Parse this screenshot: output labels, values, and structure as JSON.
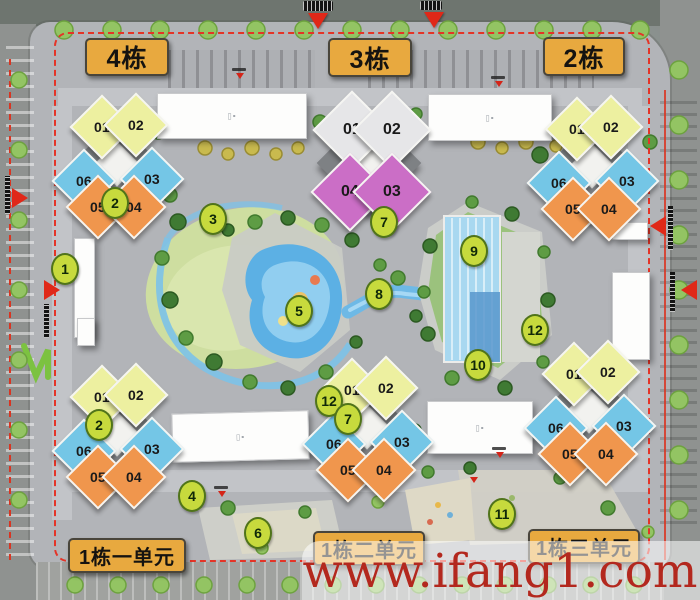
{
  "title": "residential-site-plan",
  "blocks": [
    {
      "label": "4栋",
      "units": [
        "01",
        "02",
        "06",
        "03",
        "05",
        "04"
      ]
    },
    {
      "label": "3栋",
      "units": [
        "01",
        "02",
        "04",
        "03"
      ]
    },
    {
      "label": "2栋",
      "units": [
        "01",
        "02",
        "06",
        "03",
        "05",
        "04"
      ]
    },
    {
      "label": "1栋一单元",
      "units": [
        "01",
        "02",
        "06",
        "03",
        "05",
        "04"
      ]
    },
    {
      "label": "1栋二单元",
      "units": [
        "01",
        "02",
        "06",
        "03",
        "05",
        "04"
      ]
    },
    {
      "label": "1栋三单元",
      "units": [
        "01",
        "02",
        "06",
        "03",
        "05",
        "04"
      ]
    }
  ],
  "poi_marker_instances": [
    "1",
    "2",
    "3",
    "5",
    "7",
    "8",
    "9",
    "10",
    "12",
    "2",
    "12",
    "7",
    "4",
    "6",
    "11"
  ],
  "poi_marker_set": [
    "1",
    "2",
    "3",
    "4",
    "5",
    "6",
    "7",
    "8",
    "9",
    "10",
    "11",
    "12"
  ],
  "watermark": {
    "text": "www.ifang1.com"
  },
  "colors": {
    "label_bg": "#e8a93f",
    "unit_yellow": "#edf0a0",
    "unit_blue": "#74c6e6",
    "unit_orange": "#f0964d",
    "unit_purple": "#cb6ec6",
    "unit_gray": "#e6e6e8",
    "poi_green": "#c7da3d",
    "boundary_red": "#e43427",
    "water_blue": "#6db6e8",
    "watermark_red": "#b3281e"
  }
}
